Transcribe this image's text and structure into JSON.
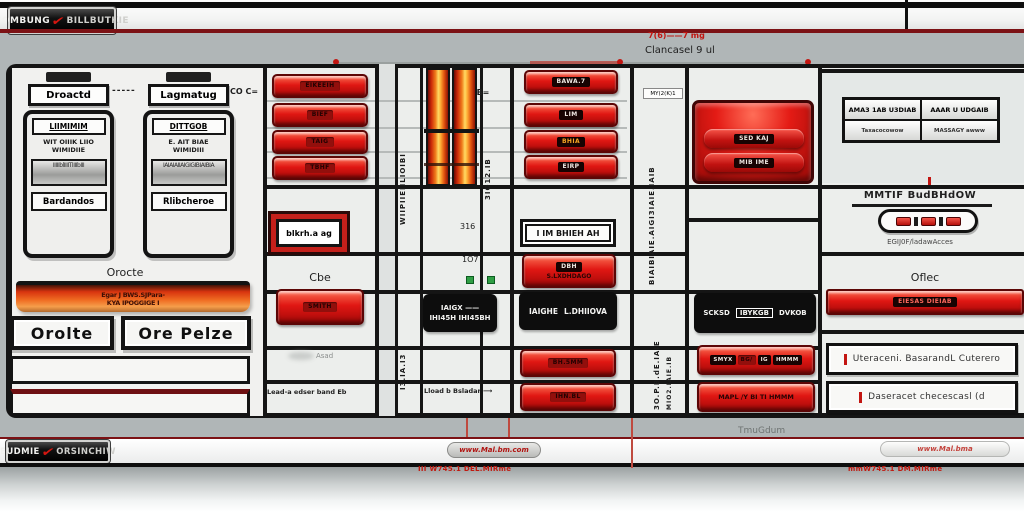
{
  "colors": {
    "accent_red": "#e01713",
    "dark_red_line": "#7c1215",
    "orange": "#f5a623",
    "green": "#2f9e44",
    "line_black": "#151515"
  },
  "header": {
    "brand_left": "SOMBUNG",
    "brand_right": "BILLBUTKIE"
  },
  "band": {
    "dose_marks": "7(6)——7 mg",
    "caption": "Clancasel 9 ul"
  },
  "connectors": {
    "dash_left": "-----",
    "dash_co": "CO C=",
    "dash_gb": "GB="
  },
  "panel_a": {
    "label": "Droactd",
    "title": "LIIMIMIM",
    "line1": "WIT OIIIK LIIO",
    "line2": "WIMIDIIE",
    "graphic": "IIIIIblIIIITIIIIbIII",
    "footer": "Bardandos"
  },
  "panel_b": {
    "label": "Lagmatug",
    "title": "DITTGOB",
    "line1": "E. AIT BIAE",
    "line2": "WIMIDIII",
    "graphic": "IAIAIAIIAIGIGIBIAIBIA",
    "footer": "Rlibcheroe"
  },
  "left_bottom": {
    "section_label": "Orocte",
    "bar_line1": "Egar J BWS.SJPara-",
    "bar_line2": "KYA IPOGGIGE I",
    "button1": "Orolte",
    "button2": "Ore Pelze"
  },
  "redstack": {
    "buttons": [
      "EIKEEIH",
      "BIEF",
      "TAIG",
      "TBHF"
    ],
    "framed": "blkrh.a ag",
    "section_label": "Cbe",
    "button5": "SMITH",
    "note": "Asad",
    "bottom_note": "Lead-a edser band Eb"
  },
  "vstrip": {
    "rot1": "WIIPIIEIILIOIBI",
    "rot2": "I3.IA.I3"
  },
  "cyl": {
    "rot_label": "3IO12.IB",
    "n1": "316",
    "n2": "1O7",
    "box_line1": "IAIGX ——",
    "box_line2": "IHI45H IHI45BH",
    "bottom_note": "Lload b Bsladar ⟶"
  },
  "bama": {
    "buttons": [
      "BAWA.7",
      "LIM",
      "BHIA",
      "EIRP"
    ],
    "framed": "I IM BHIEH AH",
    "chip": "DBH",
    "chip_sub": "S.LXDHDAGO",
    "bbox1": "IAIGHE",
    "bbox2": "L.DHIIOVA",
    "button5": "BH.5MM",
    "button6": "IHN.BL"
  },
  "rotcol": {
    "top_label": "MY(2(K)1",
    "rot1": "BIAIBIAIE.AIGI3IAIE.IAIB",
    "rot2": "3O.P.B.dE.IAIE",
    "rot3": "MIO2.IAIE.IB"
  },
  "glossy": {
    "chip1": "SED KAJ",
    "chip2": "MIB IME",
    "bbox1": "SCKSD",
    "bbox2": "IBYKGB",
    "bbox3": "DVKOB",
    "chips": [
      "SMYX",
      "BG/",
      "IG",
      "HMMM"
    ],
    "button2": "MAPL /Y BI TI HMMM"
  },
  "right": {
    "table": {
      "r1c1": "AMA3 1AB U3DIAB",
      "r1c2": "AAAR U UDGAIB",
      "r2c1": "Taxacocowow",
      "r2c2": "MASSAGY awww"
    },
    "heading": "MMTIF BudBHdOW",
    "pill_caption": "EGIJ0F/ladawAcces",
    "section_label": "Oflec",
    "bar_chip": "EIESAS DIEIAB",
    "row1": "Uteraceni. BasarandL Cuterero",
    "row2": "Daseracet checescasl (d"
  },
  "footer": {
    "brand_left": "EUDMIE",
    "brand_right": "ORSINCHIW",
    "center_badge": "www.Mal.bm.com",
    "center_note": "III W745.1 DEL.MIRme",
    "right_badge": "www.Mal.bma",
    "right_note": "mmW745.1 DM.MIRme",
    "gray_note": "TmuGdum"
  }
}
